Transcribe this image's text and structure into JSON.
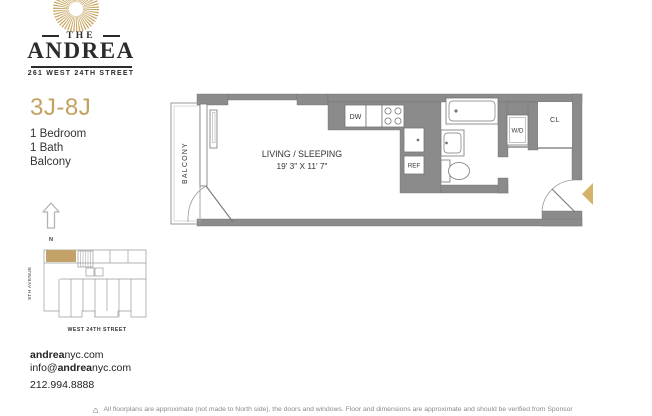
{
  "brand": {
    "the": "THE",
    "name": "ANDREA",
    "address": "261 WEST 24TH STREET"
  },
  "unit": {
    "id": "3J-8J",
    "features": [
      "1 Bedroom",
      "1 Bath",
      "Balcony"
    ]
  },
  "floorplan": {
    "room": "LIVING / SLEEPING",
    "dimensions": "19' 3\" X 11' 7\"",
    "balcony": "BALCONY",
    "dishwasher": "DW",
    "refrigerator": "REF",
    "washer_dryer": "W/D",
    "closet": "CL"
  },
  "sitemap": {
    "north": "N",
    "avenue": "8TH AVENUE",
    "street": "WEST 24TH STREET"
  },
  "contact": {
    "website_bold": "andrea",
    "website_rest": "nyc.com",
    "email_prefix": "info@",
    "email_bold": "andrea",
    "email_rest": "nyc.com",
    "phone": "212.994.8888"
  },
  "footer": {
    "disclaimer": "All floorplans are approximate (not made to North side), the doors and windows. Floor and dimensions are approximate and should be verified from Sponsor. The artist representation and..."
  },
  "colors": {
    "gold": "#c3a25f",
    "wall_gray": "#8b8b8b",
    "text_dark": "#2d2d2d"
  }
}
